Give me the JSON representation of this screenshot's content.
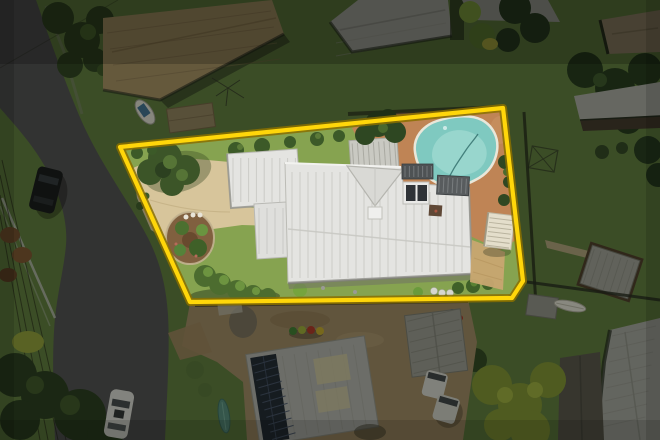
{
  "meta": {
    "description": "Aerial drone photograph of a suburban residential property highlighted with a yellow boundary outline; white-roofed house with swimming pool, terracotta pool deck, tan brick driveway and gardens; surrounding dimmed neighbourhood with curved street, parked cars, neighbouring roofs, solar panels and trees."
  },
  "palette": {
    "grass_outside": "#5c783c",
    "grass_inside": "#86a350",
    "road": "#4e4d50",
    "roof_white": "#e4e4e1",
    "roof_white_b": "#dfdfdc",
    "driveway": "#d7c59b",
    "pool_water": "#7fc9c0",
    "pool_water_light": "#9cd8cf",
    "pool_deck": "#bf8455",
    "tan_roof": "#a28c62",
    "gray_roof": "#a7a7a2",
    "dirt": "#9c8663",
    "dim_fill": "#0a0c06",
    "boundary_yellow": "#ffd60a",
    "boundary_outline": "#8a7000"
  },
  "boundary": {
    "points": "120,147 503,108 523,281 512,298 190,302",
    "dim_path": "M0,0 H660 V440 H0 Z M120,147 L503,108 L523,281 L512,298 L190,302 Z"
  },
  "hatches": {
    "mainRoofLeft": {
      "x1": 292,
      "y1": 172,
      "x2": 292,
      "y2": 278,
      "n": 14,
      "dx": 8,
      "dy": 0,
      "stroke": "#c6c6c1",
      "width": 1,
      "opacity": 0.8
    },
    "mainRoofRight": {
      "x1": 406,
      "y1": 192,
      "x2": 406,
      "y2": 272,
      "n": 8,
      "dx": 8,
      "dy": 0,
      "stroke": "#c6c6c1",
      "width": 1,
      "opacity": 0.8
    },
    "garage": {
      "x1": 233,
      "y1": 158,
      "x2": 233,
      "y2": 202,
      "n": 9,
      "dx": 7.8,
      "dy": 0,
      "stroke": "#c6c6c1",
      "width": 1,
      "opacity": 0.8
    },
    "midSection": {
      "x1": 259,
      "y1": 208,
      "x2": 259,
      "y2": 254,
      "n": 4,
      "dx": 8,
      "dy": 0,
      "stroke": "#c6c6c1",
      "width": 1,
      "opacity": 0.8
    },
    "deckPlanks": {
      "x1": 353,
      "y1": 142,
      "x2": 353,
      "y2": 169,
      "n": 9,
      "dx": 5.3,
      "dy": 0,
      "stroke": "#9d9d95",
      "width": 1,
      "opacity": 0.7
    },
    "solarPanels": {
      "x1": 257,
      "y1": 357,
      "x2": 281,
      "y2": 354,
      "n": 11,
      "dx": 0.8,
      "dy": 7.6,
      "stroke": "#46536b",
      "width": 1,
      "opacity": 0.9
    },
    "solarRoofRibs": {
      "x1": 288,
      "y1": 352,
      "x2": 288,
      "y2": 434,
      "n": 7,
      "dx": 12,
      "dy": 0,
      "stroke": "#9b9b95",
      "width": 1,
      "opacity": 0.55
    },
    "pergolaRibs": {
      "x1": 488,
      "y1": 219,
      "x2": 511,
      "y2": 219,
      "n": 7,
      "dx": 0,
      "dy": 4.6,
      "stroke": "#b5af9a",
      "width": 1,
      "opacity": 0.9
    },
    "louvreA": {
      "x1": 405,
      "y1": 166,
      "x2": 405,
      "y2": 177,
      "n": 7,
      "dx": 4.4,
      "dy": 0,
      "stroke": "#787c7e",
      "width": 1,
      "opacity": 0.9
    },
    "louvreB": {
      "x1": 439,
      "y1": 178,
      "x2": 439,
      "y2": 193,
      "n": 7,
      "dx": 4.5,
      "dy": 0,
      "stroke": "#7d8183",
      "width": 1,
      "opacity": 0.9
    },
    "tanRoofRidges": {
      "x1": 107,
      "y1": 33,
      "x2": 271,
      "y2": 11,
      "n": 4,
      "dx": 3,
      "dy": 16,
      "stroke": "#7f6c49",
      "width": 1,
      "opacity": 0.5
    },
    "topGrayRoof": {
      "x1": 336,
      "y1": 30,
      "x2": 446,
      "y2": 10,
      "n": 3,
      "dx": 0,
      "dy": 13,
      "stroke": "#96968f",
      "width": 1,
      "opacity": 0.5
    },
    "bigRoofBR": {
      "x1": 612,
      "y1": 336,
      "x2": 656,
      "y2": 326,
      "n": 8,
      "dx": -1.5,
      "dy": 13,
      "stroke": "#8b8b85",
      "width": 1,
      "opacity": 0.5
    },
    "shedRibs": {
      "x1": 410,
      "y1": 318,
      "x2": 462,
      "y2": 312,
      "n": 6,
      "dx": 0,
      "dy": 10.5,
      "stroke": "#7c7c74",
      "width": 1,
      "opacity": 0.6
    },
    "seHouseRibs": {
      "x1": 588,
      "y1": 255,
      "x2": 588,
      "y2": 291,
      "n": 7,
      "dx": 7,
      "dy": 0,
      "stroke": "#83837c",
      "width": 1,
      "opacity": 0.6
    }
  }
}
